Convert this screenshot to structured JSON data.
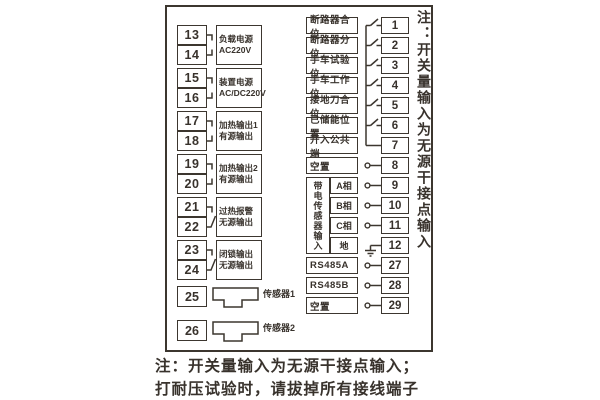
{
  "left": {
    "pairs": [
      {
        "t1": "13",
        "t2": "14",
        "line1": "负载电源",
        "line2": "AC220V"
      },
      {
        "t1": "15",
        "t2": "16",
        "line1": "装置电源",
        "line2": "AC/DC220V"
      },
      {
        "t1": "17",
        "t2": "18",
        "line1": "加热输出1",
        "line2": "有源输出"
      },
      {
        "t1": "19",
        "t2": "20",
        "line1": "加热输出2",
        "line2": "有源输出"
      },
      {
        "t1": "21",
        "t2": "22",
        "line1": "过热报警",
        "line2": "无源输出"
      },
      {
        "t1": "23",
        "t2": "24",
        "line1": "闭锁输出",
        "line2": "无源输出"
      }
    ],
    "sensors": [
      {
        "terminal": "25",
        "label": "传感器1"
      },
      {
        "terminal": "26",
        "label": "传感器2"
      }
    ]
  },
  "right": {
    "rows": [
      {
        "label": "断路器合位",
        "terminal": "1"
      },
      {
        "label": "断路器分位",
        "terminal": "2"
      },
      {
        "label": "手车试验位",
        "terminal": "3"
      },
      {
        "label": "手车工作位",
        "terminal": "4"
      },
      {
        "label": "接地刀合位",
        "terminal": "5"
      },
      {
        "label": "已储能位置",
        "terminal": "6"
      },
      {
        "label": "开入公共端",
        "terminal": "7"
      },
      {
        "label": "空置",
        "terminal": "8"
      }
    ],
    "hv_group": {
      "label": "带电传感器输入",
      "phases": [
        {
          "label": "A相",
          "terminal": "9"
        },
        {
          "label": "B相",
          "terminal": "10"
        },
        {
          "label": "C相",
          "terminal": "11"
        },
        {
          "label": "地",
          "terminal": "12"
        }
      ]
    },
    "comm_rows": [
      {
        "label": "RS485A",
        "terminal": "27"
      },
      {
        "label": "RS485B",
        "terminal": "28"
      },
      {
        "label": "空置",
        "terminal": "29"
      }
    ]
  },
  "notes": {
    "side_vertical": "注：开关量输入为无源干接点输入",
    "bottom_line1": "注：开关量输入为无源干接点输入；",
    "bottom_line2": "打耐压试验时，请拔掉所有接线端子"
  },
  "colors": {
    "ink": "#38322c",
    "background": "#ffffff"
  }
}
